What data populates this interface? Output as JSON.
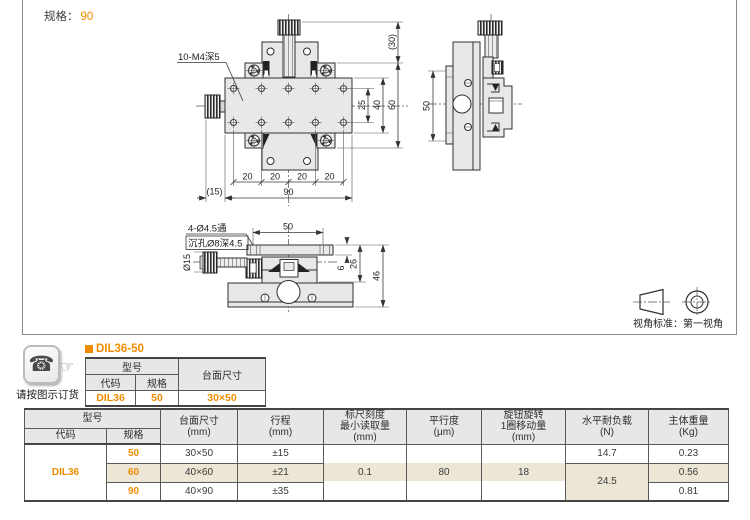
{
  "colors": {
    "accent_orange": "#f08c00",
    "row_highlight": "#ebe6d5",
    "table_header_bg": "#e7e7e7"
  },
  "header": {
    "spec_label": "规格：",
    "spec_value": "90"
  },
  "drawing": {
    "thread_callout": "10-M4深5",
    "hole_callout_line1": "4-Ø4.5通",
    "hole_callout_line2": "沉孔Ø8深4.5",
    "knob_diameter": "Ø15",
    "dims": {
      "knob_height": "(30)",
      "body_width": "60",
      "hole_span_outer": "40",
      "hole_span_inner": "25",
      "pitch": "20",
      "total_width": "90",
      "knob_offset": "(15)",
      "side_height": "50",
      "table_span": "50",
      "plate_thickness": "6",
      "mid_height": "26",
      "total_height": "46"
    },
    "view_standard": "视角标准：第一视角"
  },
  "order_note": {
    "caption": "请按图示订货"
  },
  "part_table": {
    "title": "DIL36-50",
    "header_model": "型号",
    "header_code": "代码",
    "header_spec": "规格",
    "header_size": "台面尺寸",
    "code": "DIL36",
    "spec": "50",
    "size": "30×50"
  },
  "spec_table": {
    "header_model": "型号",
    "header_code": "代码",
    "header_spec": "规格",
    "header_size": "台面尺寸\n(mm)",
    "header_stroke": "行程\n(mm)",
    "header_min_reading": "标尺刻度\n最小读取量\n(mm)",
    "header_parallelism": "平行度\n(μm)",
    "header_per_turn": "旋钮旋转\n1圈移动量\n(mm)",
    "header_load": "水平耐负载\n(N)",
    "header_weight": "主体重量\n(Kg)",
    "code": "DIL36",
    "min_reading": "0.1",
    "parallelism": "80",
    "per_turn": "18",
    "load_50": "14.7",
    "load_60_90": "24.5",
    "rows": [
      {
        "spec": "50",
        "size": "30×50",
        "stroke": "±15",
        "weight": "0.23"
      },
      {
        "spec": "60",
        "size": "40×60",
        "stroke": "±21",
        "weight": "0.56"
      },
      {
        "spec": "90",
        "size": "40×90",
        "stroke": "±35",
        "weight": "0.81"
      }
    ]
  }
}
